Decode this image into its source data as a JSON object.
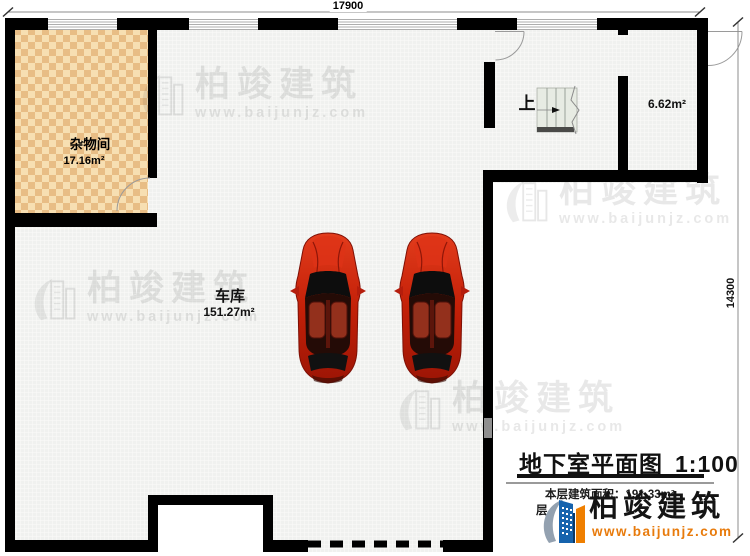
{
  "dimensions": {
    "top": "17900",
    "right": "14300"
  },
  "rooms": {
    "storage": {
      "name": "杂物间",
      "area": "17.16m²"
    },
    "garage": {
      "name": "车库",
      "area": "151.27m²"
    },
    "small_room": {
      "area": "6.62m²"
    }
  },
  "stairs": {
    "up_label": "上"
  },
  "watermark": {
    "brand": "柏竣建筑",
    "url": "www.baijunjz.com"
  },
  "title_block": {
    "title": "地下室平面图",
    "scale": "1:100",
    "area_note": "本层建筑面积：191.33m²",
    "note2_fragment_left": "层",
    "note2_fragment_right": "2."
  },
  "logo": {
    "brand": "柏竣建筑",
    "url": "www.baijunjz.com"
  },
  "colors": {
    "wall": "#000000",
    "floor": "#f0f1ef",
    "checker_light": "#f7dfb2",
    "checker_dark": "#e8bd85",
    "car_red": "#c32008",
    "logo_blue": "#1663ad",
    "logo_orange": "#ef7f00",
    "url_orange": "#e87b0c",
    "watermark_grey": "#dedede"
  }
}
